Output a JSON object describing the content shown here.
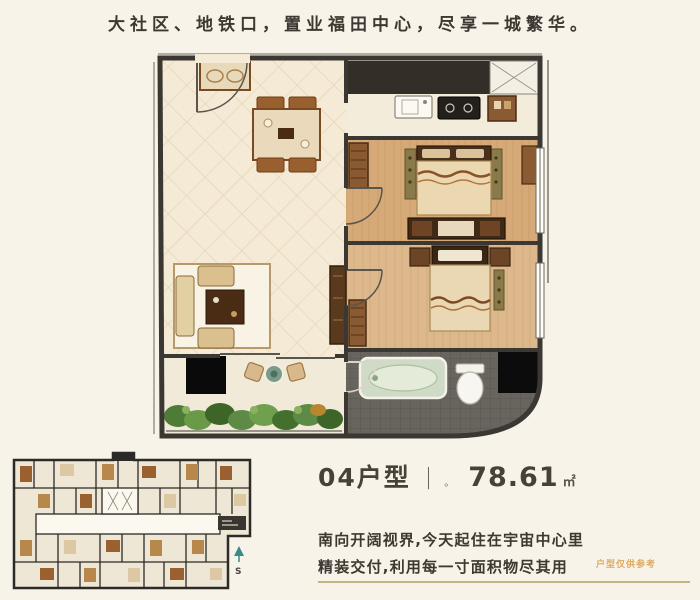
{
  "header": {
    "headline": "大社区、地铁口，置业福田中心，尽享一城繁华。"
  },
  "unit_info": {
    "name": "04户型",
    "divider": "|",
    "dot": "。",
    "area": "78.61",
    "area_unit": "㎡"
  },
  "description": {
    "line1": "南向开阔视界,今天起住在宇宙中心里",
    "line2": "精装交付,利用每一寸面积物尽其用",
    "disclaimer": "户型仅供参考"
  },
  "key_plan": {
    "compass_label": "S"
  },
  "colors": {
    "background": "#f8f3e9",
    "wall": "#3b3733",
    "floor_cream": "#f4ead5",
    "wood_floor": "#d6aa78",
    "bath_gray": "#67655d",
    "plant_green": "#5d8a44",
    "accent_gold": "#c9b285",
    "disclaimer_orange": "#dcaa5e",
    "text_dark": "#3e3832"
  }
}
